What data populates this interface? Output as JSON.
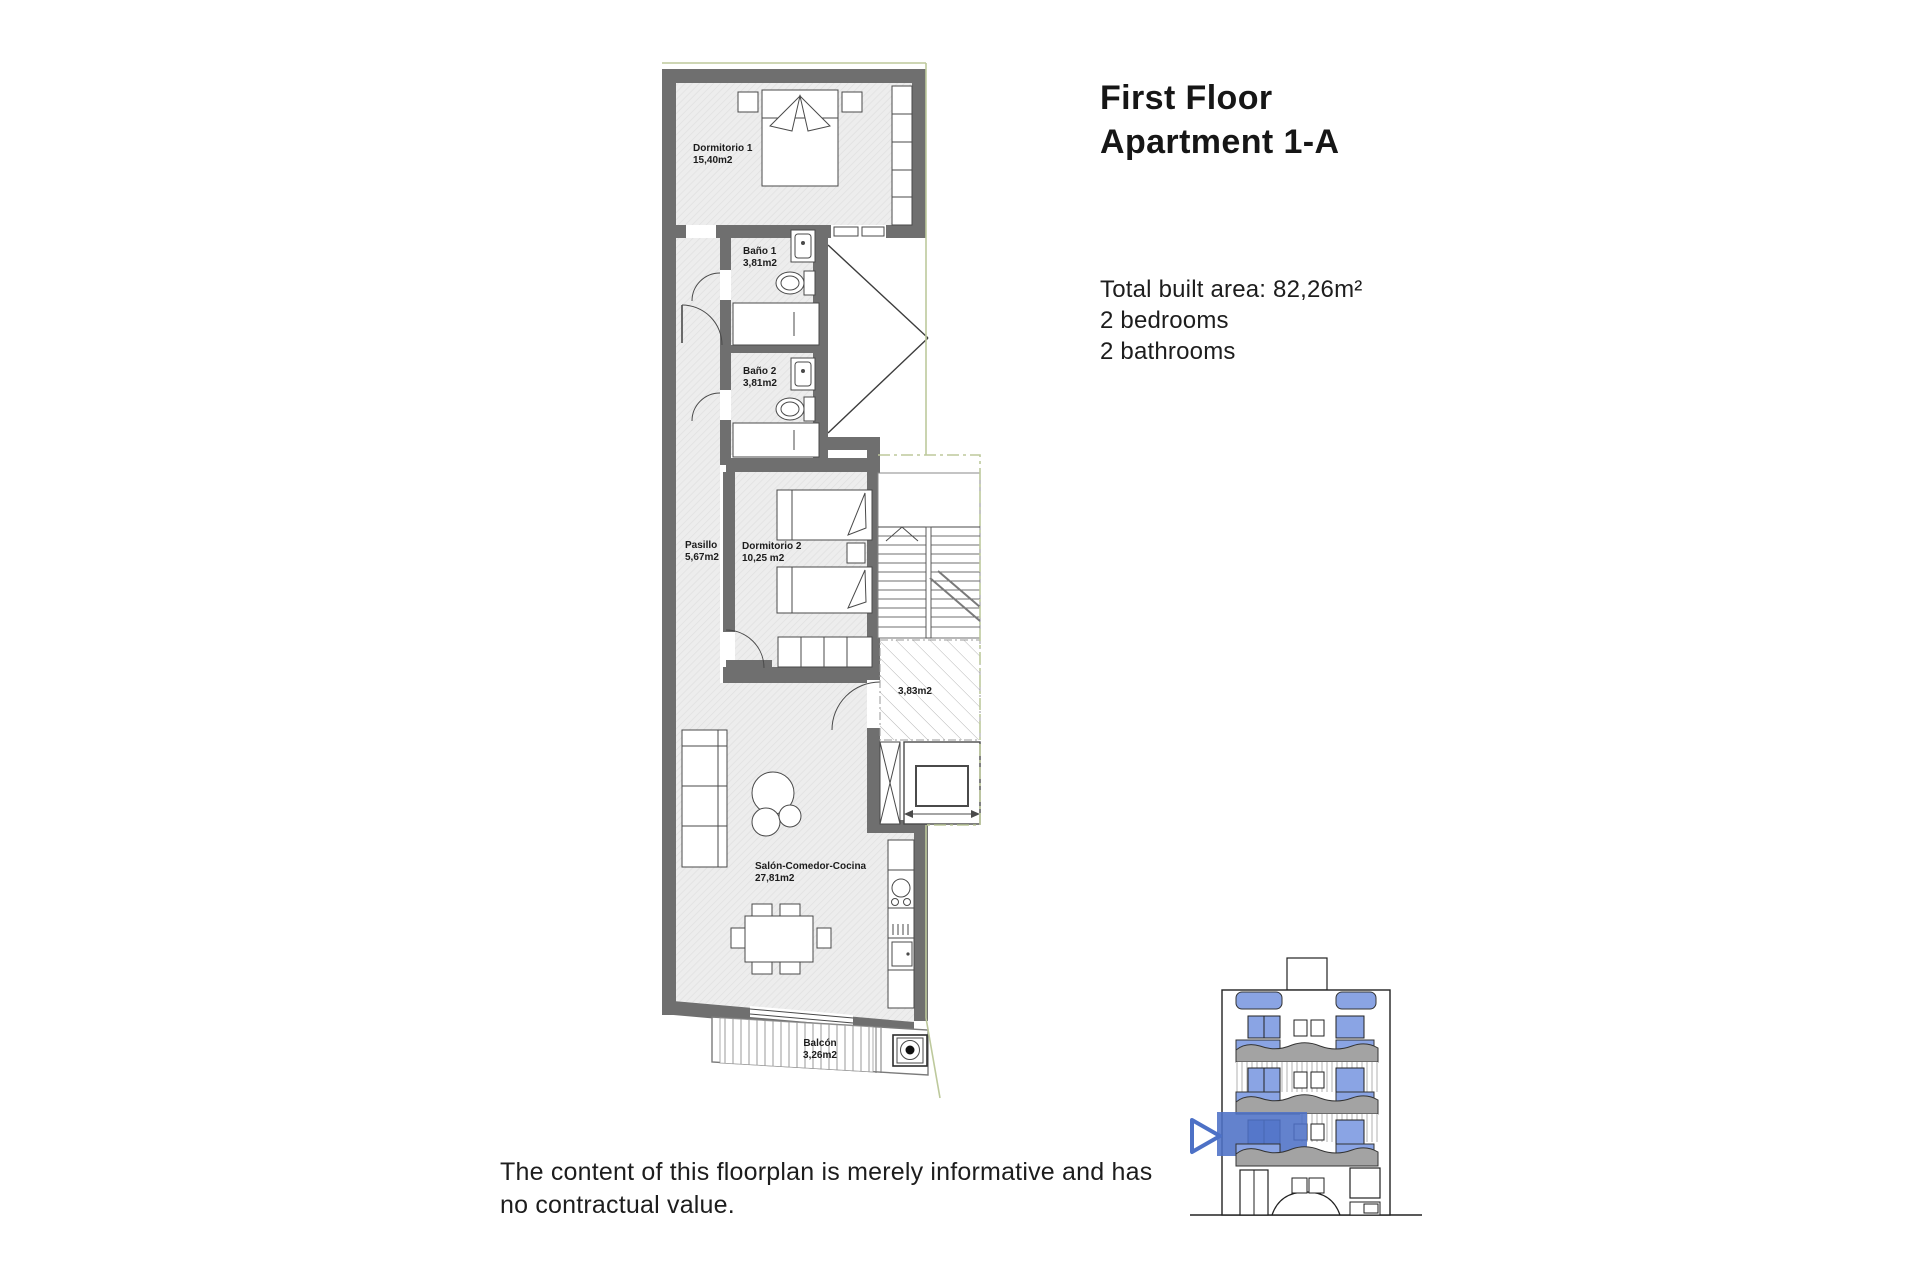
{
  "header": {
    "line1": "First Floor",
    "line2": "Apartment 1-A"
  },
  "details": {
    "total_area": "Total built area: 82,26m²",
    "bedrooms": "2 bedrooms",
    "bathrooms": "2 bathrooms"
  },
  "disclaimer": {
    "text": "The content of this floorplan is merely informative and has no contractual value."
  },
  "floorplan": {
    "dormitorio1": {
      "name": "Dormitorio 1",
      "area": "15,40m2"
    },
    "bano1": {
      "name": "Baño 1",
      "area": "3,81m2"
    },
    "bano2": {
      "name": "Baño 2",
      "area": "3,81m2"
    },
    "pasillo": {
      "name": "Pasillo",
      "area": "5,67m2"
    },
    "dormitorio2": {
      "name": "Dormitorio 2",
      "area": "10,25 m2"
    },
    "salon": {
      "name": "Salón-Comedor-Cocina",
      "area": "27,81m2"
    },
    "balcon": {
      "name": "Balcón",
      "area": "3,26m2"
    },
    "landing": {
      "area": "3,83m2"
    }
  },
  "colors": {
    "wall_gray": "#6f6f6f",
    "boundary_green": "#bdc99c",
    "accent_blue": "#4d71c6",
    "light_blue": "#8aa4e4",
    "slab_gray": "#a3a3a3"
  }
}
